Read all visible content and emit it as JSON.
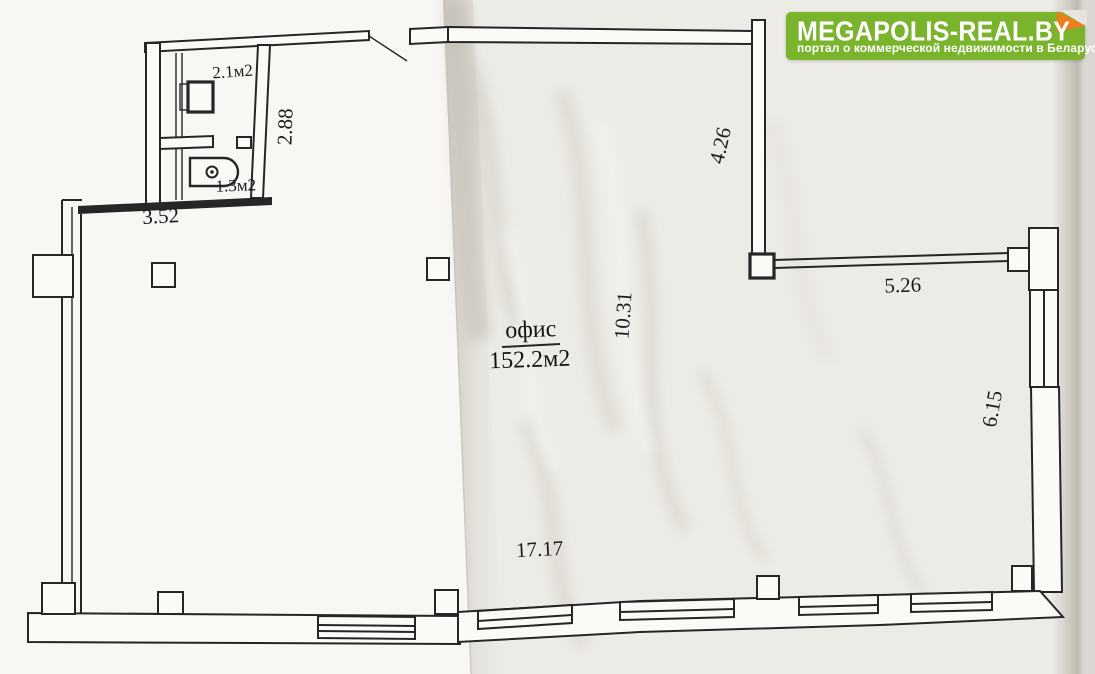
{
  "brand": {
    "title": "MEGAPOLIS-REAL.BY",
    "subtitle": "портал о коммерческой недвижимости в Беларуси",
    "green": "#79b42c",
    "orange": "#ee7d1c"
  },
  "plan": {
    "ink": "#262626",
    "unit": {
      "label": "офис",
      "area": "152.2м2"
    },
    "rooms": [
      {
        "id": "utility-room",
        "area": "2.1м2"
      },
      {
        "id": "wc-room",
        "area": "1.3м2"
      }
    ],
    "dimensions": {
      "top_left_width": "3.52",
      "wc_height": "2.88",
      "upper_right_height": "4.26",
      "right_top_width": "5.26",
      "hall_depth": "10.31",
      "right_height": "6.15",
      "bottom_width": "17.17"
    }
  }
}
